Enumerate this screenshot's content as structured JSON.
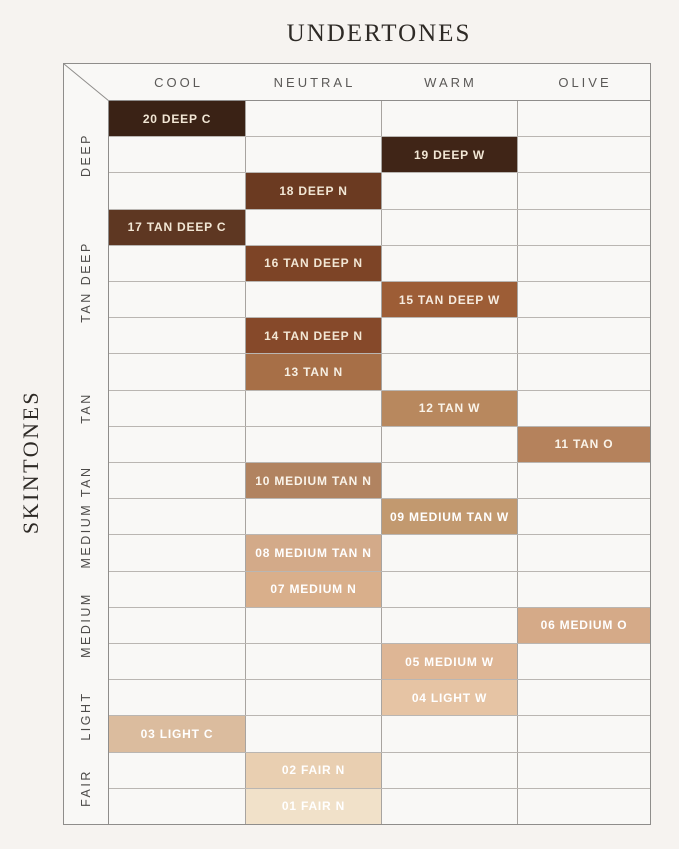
{
  "chart_data": {
    "type": "heatmap",
    "title": "UNDERTONES",
    "ylabel": "SKINTONES",
    "legend": "none",
    "grid": true,
    "x_categories": [
      "COOL",
      "NEUTRAL",
      "WARM",
      "OLIVE"
    ],
    "row_count": 20,
    "row_groups": [
      {
        "label": "DEEP",
        "start_row": 1,
        "end_row": 3
      },
      {
        "label": "TAN DEEP",
        "start_row": 4,
        "end_row": 7
      },
      {
        "label": "TAN",
        "start_row": 8,
        "end_row": 10
      },
      {
        "label": "MEDIUM TAN",
        "start_row": 11,
        "end_row": 13
      },
      {
        "label": "MEDIUM",
        "start_row": 14,
        "end_row": 16
      },
      {
        "label": "LIGHT",
        "start_row": 17,
        "end_row": 18
      },
      {
        "label": "FAIR",
        "start_row": 19,
        "end_row": 20
      }
    ],
    "rows": [
      {
        "row": 1,
        "label": "20 DEEP C",
        "shade": "20",
        "skintone": "DEEP",
        "undertone": "COOL",
        "color": "#3a2215",
        "text_color": "#f2e7d5"
      },
      {
        "row": 2,
        "label": "19 DEEP W",
        "shade": "19",
        "skintone": "DEEP",
        "undertone": "WARM",
        "color": "#402517",
        "text_color": "#f2e7d5"
      },
      {
        "row": 3,
        "label": "18 DEEP N",
        "shade": "18",
        "skintone": "DEEP",
        "undertone": "NEUTRAL",
        "color": "#6b3a21",
        "text_color": "#f2e7d5"
      },
      {
        "row": 4,
        "label": "17 TAN DEEP C",
        "shade": "17",
        "skintone": "TAN DEEP",
        "undertone": "COOL",
        "color": "#5e3722",
        "text_color": "#f2e7d5"
      },
      {
        "row": 5,
        "label": "16 TAN DEEP N",
        "shade": "16",
        "skintone": "TAN DEEP",
        "undertone": "NEUTRAL",
        "color": "#7d4426",
        "text_color": "#f2e7d5"
      },
      {
        "row": 6,
        "label": "15 TAN DEEP W",
        "shade": "15",
        "skintone": "TAN DEEP",
        "undertone": "WARM",
        "color": "#9d5d36",
        "text_color": "#f6ece0"
      },
      {
        "row": 7,
        "label": "14 TAN DEEP N",
        "shade": "14",
        "skintone": "TAN DEEP",
        "undertone": "NEUTRAL",
        "color": "#86492a",
        "text_color": "#f2e7d5"
      },
      {
        "row": 8,
        "label": "13 TAN N",
        "shade": "13",
        "skintone": "TAN",
        "undertone": "NEUTRAL",
        "color": "#a76f47",
        "text_color": "#f6efe3"
      },
      {
        "row": 9,
        "label": "12 TAN W",
        "shade": "12",
        "skintone": "TAN",
        "undertone": "WARM",
        "color": "#b8885e",
        "text_color": "#faf4ea"
      },
      {
        "row": 10,
        "label": "11 TAN O",
        "shade": "11",
        "skintone": "TAN",
        "undertone": "OLIVE",
        "color": "#b5825c",
        "text_color": "#faf4ea"
      },
      {
        "row": 11,
        "label": "10 MEDIUM TAN N",
        "shade": "10",
        "skintone": "MEDIUM TAN",
        "undertone": "NEUTRAL",
        "color": "#b18360",
        "text_color": "#faf4ea"
      },
      {
        "row": 12,
        "label": "09 MEDIUM TAN W",
        "shade": "09",
        "skintone": "MEDIUM TAN",
        "undertone": "WARM",
        "color": "#c2996f",
        "text_color": "#ffffff"
      },
      {
        "row": 13,
        "label": "08 MEDIUM TAN N",
        "shade": "08",
        "skintone": "MEDIUM TAN",
        "undertone": "NEUTRAL",
        "color": "#d3aa89",
        "text_color": "#ffffff"
      },
      {
        "row": 14,
        "label": "07 MEDIUM N",
        "shade": "07",
        "skintone": "MEDIUM",
        "undertone": "NEUTRAL",
        "color": "#d9af8b",
        "text_color": "#ffffff"
      },
      {
        "row": 15,
        "label": "06 MEDIUM O",
        "shade": "06",
        "skintone": "MEDIUM",
        "undertone": "OLIVE",
        "color": "#d5aa88",
        "text_color": "#ffffff"
      },
      {
        "row": 16,
        "label": "05 MEDIUM W",
        "shade": "05",
        "skintone": "MEDIUM",
        "undertone": "WARM",
        "color": "#deb695",
        "text_color": "#ffffff"
      },
      {
        "row": 17,
        "label": "04 LIGHT W",
        "shade": "04",
        "skintone": "LIGHT",
        "undertone": "WARM",
        "color": "#e6c4a4",
        "text_color": "#ffffff"
      },
      {
        "row": 18,
        "label": "03 LIGHT C",
        "shade": "03",
        "skintone": "LIGHT",
        "undertone": "COOL",
        "color": "#dbbc9e",
        "text_color": "#ffffff"
      },
      {
        "row": 19,
        "label": "02 FAIR N",
        "shade": "02",
        "skintone": "FAIR",
        "undertone": "NEUTRAL",
        "color": "#e9cfb1",
        "text_color": "#ffffff"
      },
      {
        "row": 20,
        "label": "01 FAIR N",
        "shade": "01",
        "skintone": "FAIR",
        "undertone": "NEUTRAL",
        "color": "#f1e1c9",
        "text_color": "#ffffff"
      }
    ]
  }
}
